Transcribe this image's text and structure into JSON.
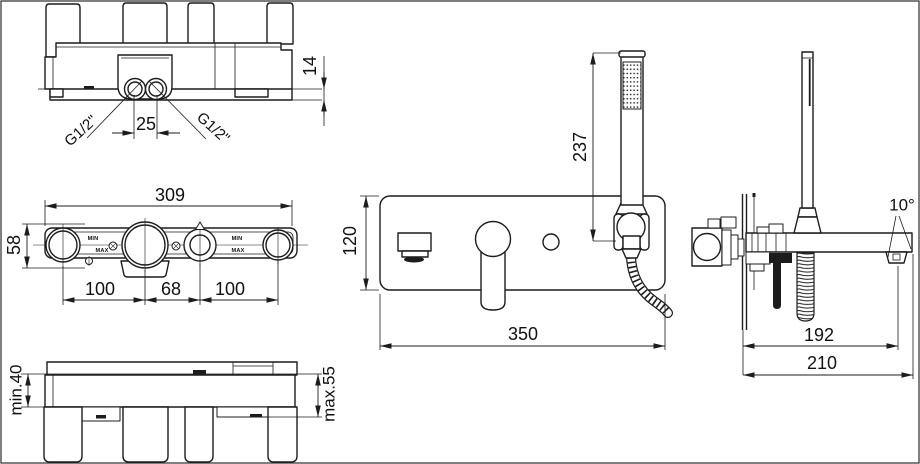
{
  "views": {
    "rough_top": {
      "dim_port_spacing": "25",
      "dim_plate_offset": "14",
      "thread_left": "G1/2\"",
      "thread_right": "G1/2\""
    },
    "rough_front": {
      "dim_overall_width": "309",
      "dim_overall_height": "58",
      "dim_spacing_left": "100",
      "dim_spacing_center": "68",
      "dim_spacing_right": "100",
      "label_min": "MIN",
      "label_max": "MAX"
    },
    "rough_side": {
      "dim_depth_min": "min.40",
      "dim_depth_max": "max.55"
    },
    "trim_front": {
      "dim_handshower_height": "237",
      "dim_plate_height": "120",
      "dim_plate_width": "350"
    },
    "trim_side": {
      "dim_spout_angle": "10°",
      "dim_spout_reach": "192",
      "dim_total_reach": "210"
    }
  }
}
